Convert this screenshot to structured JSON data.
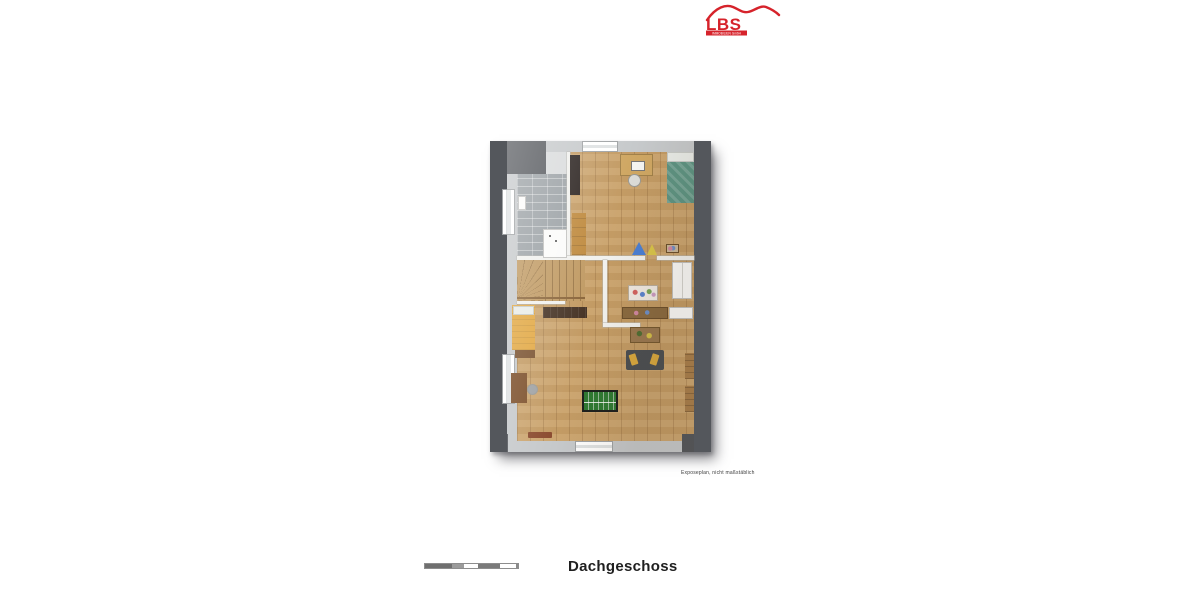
{
  "header": {
    "logo_brand": "LBS",
    "logo_tagline": "IMMOBILIEN GmbH"
  },
  "plan": {
    "caption": "Exposeplan, nicht maßstäblich"
  },
  "footer": {
    "floor_title": "Dachgeschoss"
  },
  "colors": {
    "brand_red": "#d6232b",
    "roof_gray": "#54575c",
    "wall_gray": "#c6c9cb",
    "floor_wood": "#c9a169",
    "tile_gray": "#9ba1a5",
    "bed_teal": "#5d9483",
    "bed_yellow": "#e2a843",
    "foosball_green": "#2f7a33",
    "text_dark": "#1f1f1f"
  }
}
